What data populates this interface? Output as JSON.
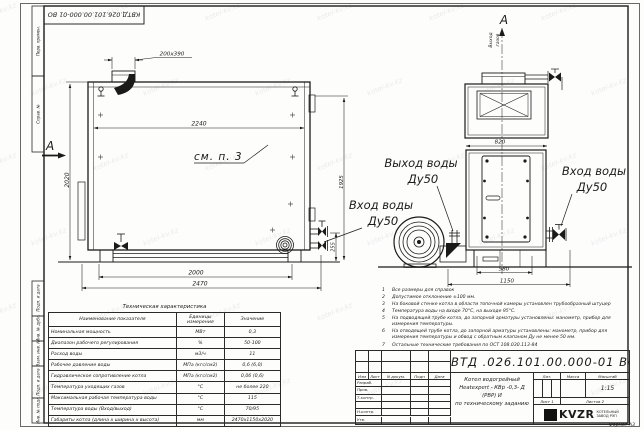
{
  "sheet": {
    "top_stamp_number": "КВТД.026.101.00.000-01  ВО",
    "format_label": "Формат   А3",
    "watermark": "kotel-kv.kz",
    "margin_labels": [
      "Перв. примен.",
      "Справ. №",
      "Подп. и дата",
      "Инв. № дубл.",
      "Взам. инв. №",
      "Подп. и дата",
      "Инв. № подл."
    ]
  },
  "side_view": {
    "section_letter": "А",
    "note_ref": "см. п. 3",
    "dim_nozzle": "200х390",
    "dim_width_top": "2240",
    "dim_height_left": "2020",
    "dim_height_right": "1925",
    "dim_outlet_height": "255",
    "dim_feet": "2000",
    "dim_length": "2470",
    "inlet_label_1": "Вход воды",
    "inlet_label_2": "Ду50"
  },
  "front_view": {
    "section_letter": "А",
    "gas_outlet_1": "Выход",
    "gas_outlet_2": "газов",
    "dim_width": "820",
    "dim_base": "580",
    "dim_total": "1150",
    "outlet_label_1": "Выход воды",
    "outlet_label_2": "Ду50",
    "inlet_label_1": "Вход воды",
    "inlet_label_2": "Ду50"
  },
  "notes": [
    {
      "num": "1",
      "text": "Все размеры для справок"
    },
    {
      "num": "2",
      "text": "Допустимое отклонение ±100 мм."
    },
    {
      "num": "3",
      "text": "На боковой стенке котла в области топочной камеры установлен трубообразный штуцер"
    },
    {
      "num": "4",
      "text": "Температура воды на входе 70°С, на выходе 95°С."
    },
    {
      "num": "5",
      "text": "На подводящей трубе котла, до запорной арматуры установлены: манометр, прибор для измерения температуры."
    },
    {
      "num": "6",
      "text": "На отводящей трубе котла, до запорной арматуры установлены: манометр, прибор для измерения температуры и обвод с обратным клапаном Ду не менее 50 мм."
    },
    {
      "num": "7",
      "text": "Остальные технические требования по ОСТ 108.030.113-84"
    }
  ],
  "spec_table": {
    "title": "Техническая характеристика",
    "col_name": "Наименование показателя",
    "col_units_1": "Единицы",
    "col_units_2": "измерения",
    "col_value": "Значение",
    "rows": [
      [
        "Номинальная мощность",
        "МВт",
        "0,3"
      ],
      [
        "Диапазон рабочего регулирования",
        "%",
        "50-100"
      ],
      [
        "Расход воды",
        "м3/ч",
        "11"
      ],
      [
        "Рабочее давление воды",
        "МПа (кгс/см2)",
        "0,6 (6,0)"
      ],
      [
        "Гидравлическое сопротивление котла",
        "МПа (кгс/см2)",
        "0,06 (0,6)"
      ],
      [
        "Температура уходящих газов",
        "°С",
        "не более 220"
      ],
      [
        "Максимальная рабочая температура воды",
        "°С",
        "115"
      ],
      [
        "Температура воды (Вход/выход)",
        "°С",
        "70/95"
      ],
      [
        "Габариты котла (длина х ширина х высота)",
        "мм",
        "2470х1150х2020"
      ]
    ]
  },
  "title_block": {
    "doc_number": "КВТД .026.101.00.000-01  ВО",
    "product_line1": "Котел водогрейный",
    "product_line2": "Heatexpert - КВр -0,3- Д (РВР) И",
    "product_line3": "по техническому заданию",
    "col_izm": "Изм",
    "col_list": "Лист",
    "col_doc": "N докум.",
    "col_sign": "Подп",
    "col_date": "Дата",
    "row_razrab": "Разраб.",
    "row_prov": "Пров.",
    "row_tkontr": "Т.контр.",
    "row_nkontr": "Н.контр.",
    "row_utv": "Утв.",
    "lit_label": "Лит.",
    "mass_label": "Масса",
    "scale_label": "Масштаб",
    "scale_value": "1:15",
    "sheet_label": "Лист 1",
    "sheets_label": "Листов 2",
    "logo_text": "KVZR",
    "logo_sub1": "КОТЕЛЬНЫЙ",
    "logo_sub2": "ЗАВОД РЭП"
  }
}
